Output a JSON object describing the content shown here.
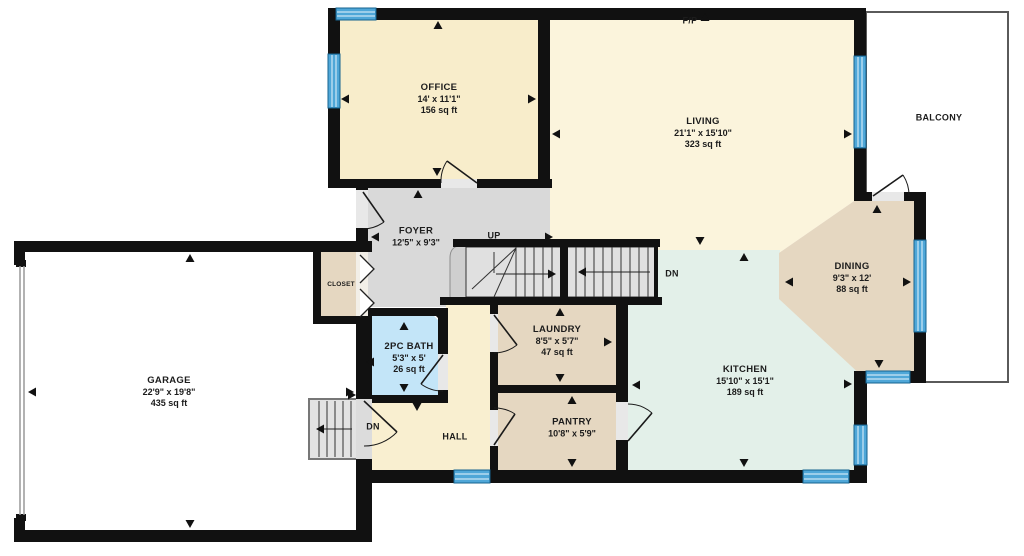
{
  "rooms": {
    "office": {
      "name": "OFFICE",
      "dims": "14' x 11'1\"",
      "area": "156 sq ft"
    },
    "living": {
      "name": "LIVING",
      "dims": "21'1\" x 15'10\"",
      "area": "323 sq ft"
    },
    "dining": {
      "name": "DINING",
      "dims": "9'3\" x 12'",
      "area": "88 sq ft"
    },
    "kitchen": {
      "name": "KITCHEN",
      "dims": "15'10\" x 15'1\"",
      "area": "189 sq ft"
    },
    "garage": {
      "name": "GARAGE",
      "dims": "22'9\" x 19'8\"",
      "area": "435 sq ft"
    },
    "bath": {
      "name": "2PC BATH",
      "dims": "5'3\" x 5'",
      "area": "26 sq ft"
    },
    "laundry": {
      "name": "LAUNDRY",
      "dims": "8'5\" x 5'7\"",
      "area": "47 sq ft"
    },
    "pantry": {
      "name": "PANTRY",
      "dims": "10'8\" x 5'9\""
    },
    "foyer": {
      "name": "FOYER",
      "dims": "12'5\" x 9'3\""
    },
    "hall": {
      "name": "HALL"
    },
    "closet": {
      "name": "CLOSET"
    },
    "balcony": {
      "name": "BALCONY"
    }
  },
  "annotations": {
    "up": "UP",
    "dn_main": "DN",
    "dn_entry": "DN",
    "fireplace": "F/P"
  },
  "colors": {
    "wall": "#111111",
    "window": "#4FA7D8",
    "window_frame": "#16638F",
    "cream": "#F8EDCB",
    "cream_light": "#FBF4DC",
    "hall_cream": "#F9EFD0",
    "tan": "#E5D7C1",
    "gray": "#D9D9D9",
    "mint": "#E3F0E9",
    "bath_blue": "#C3E5F8",
    "stair_tread": "#E0E0E0",
    "threshold": "#E8E8E8"
  }
}
